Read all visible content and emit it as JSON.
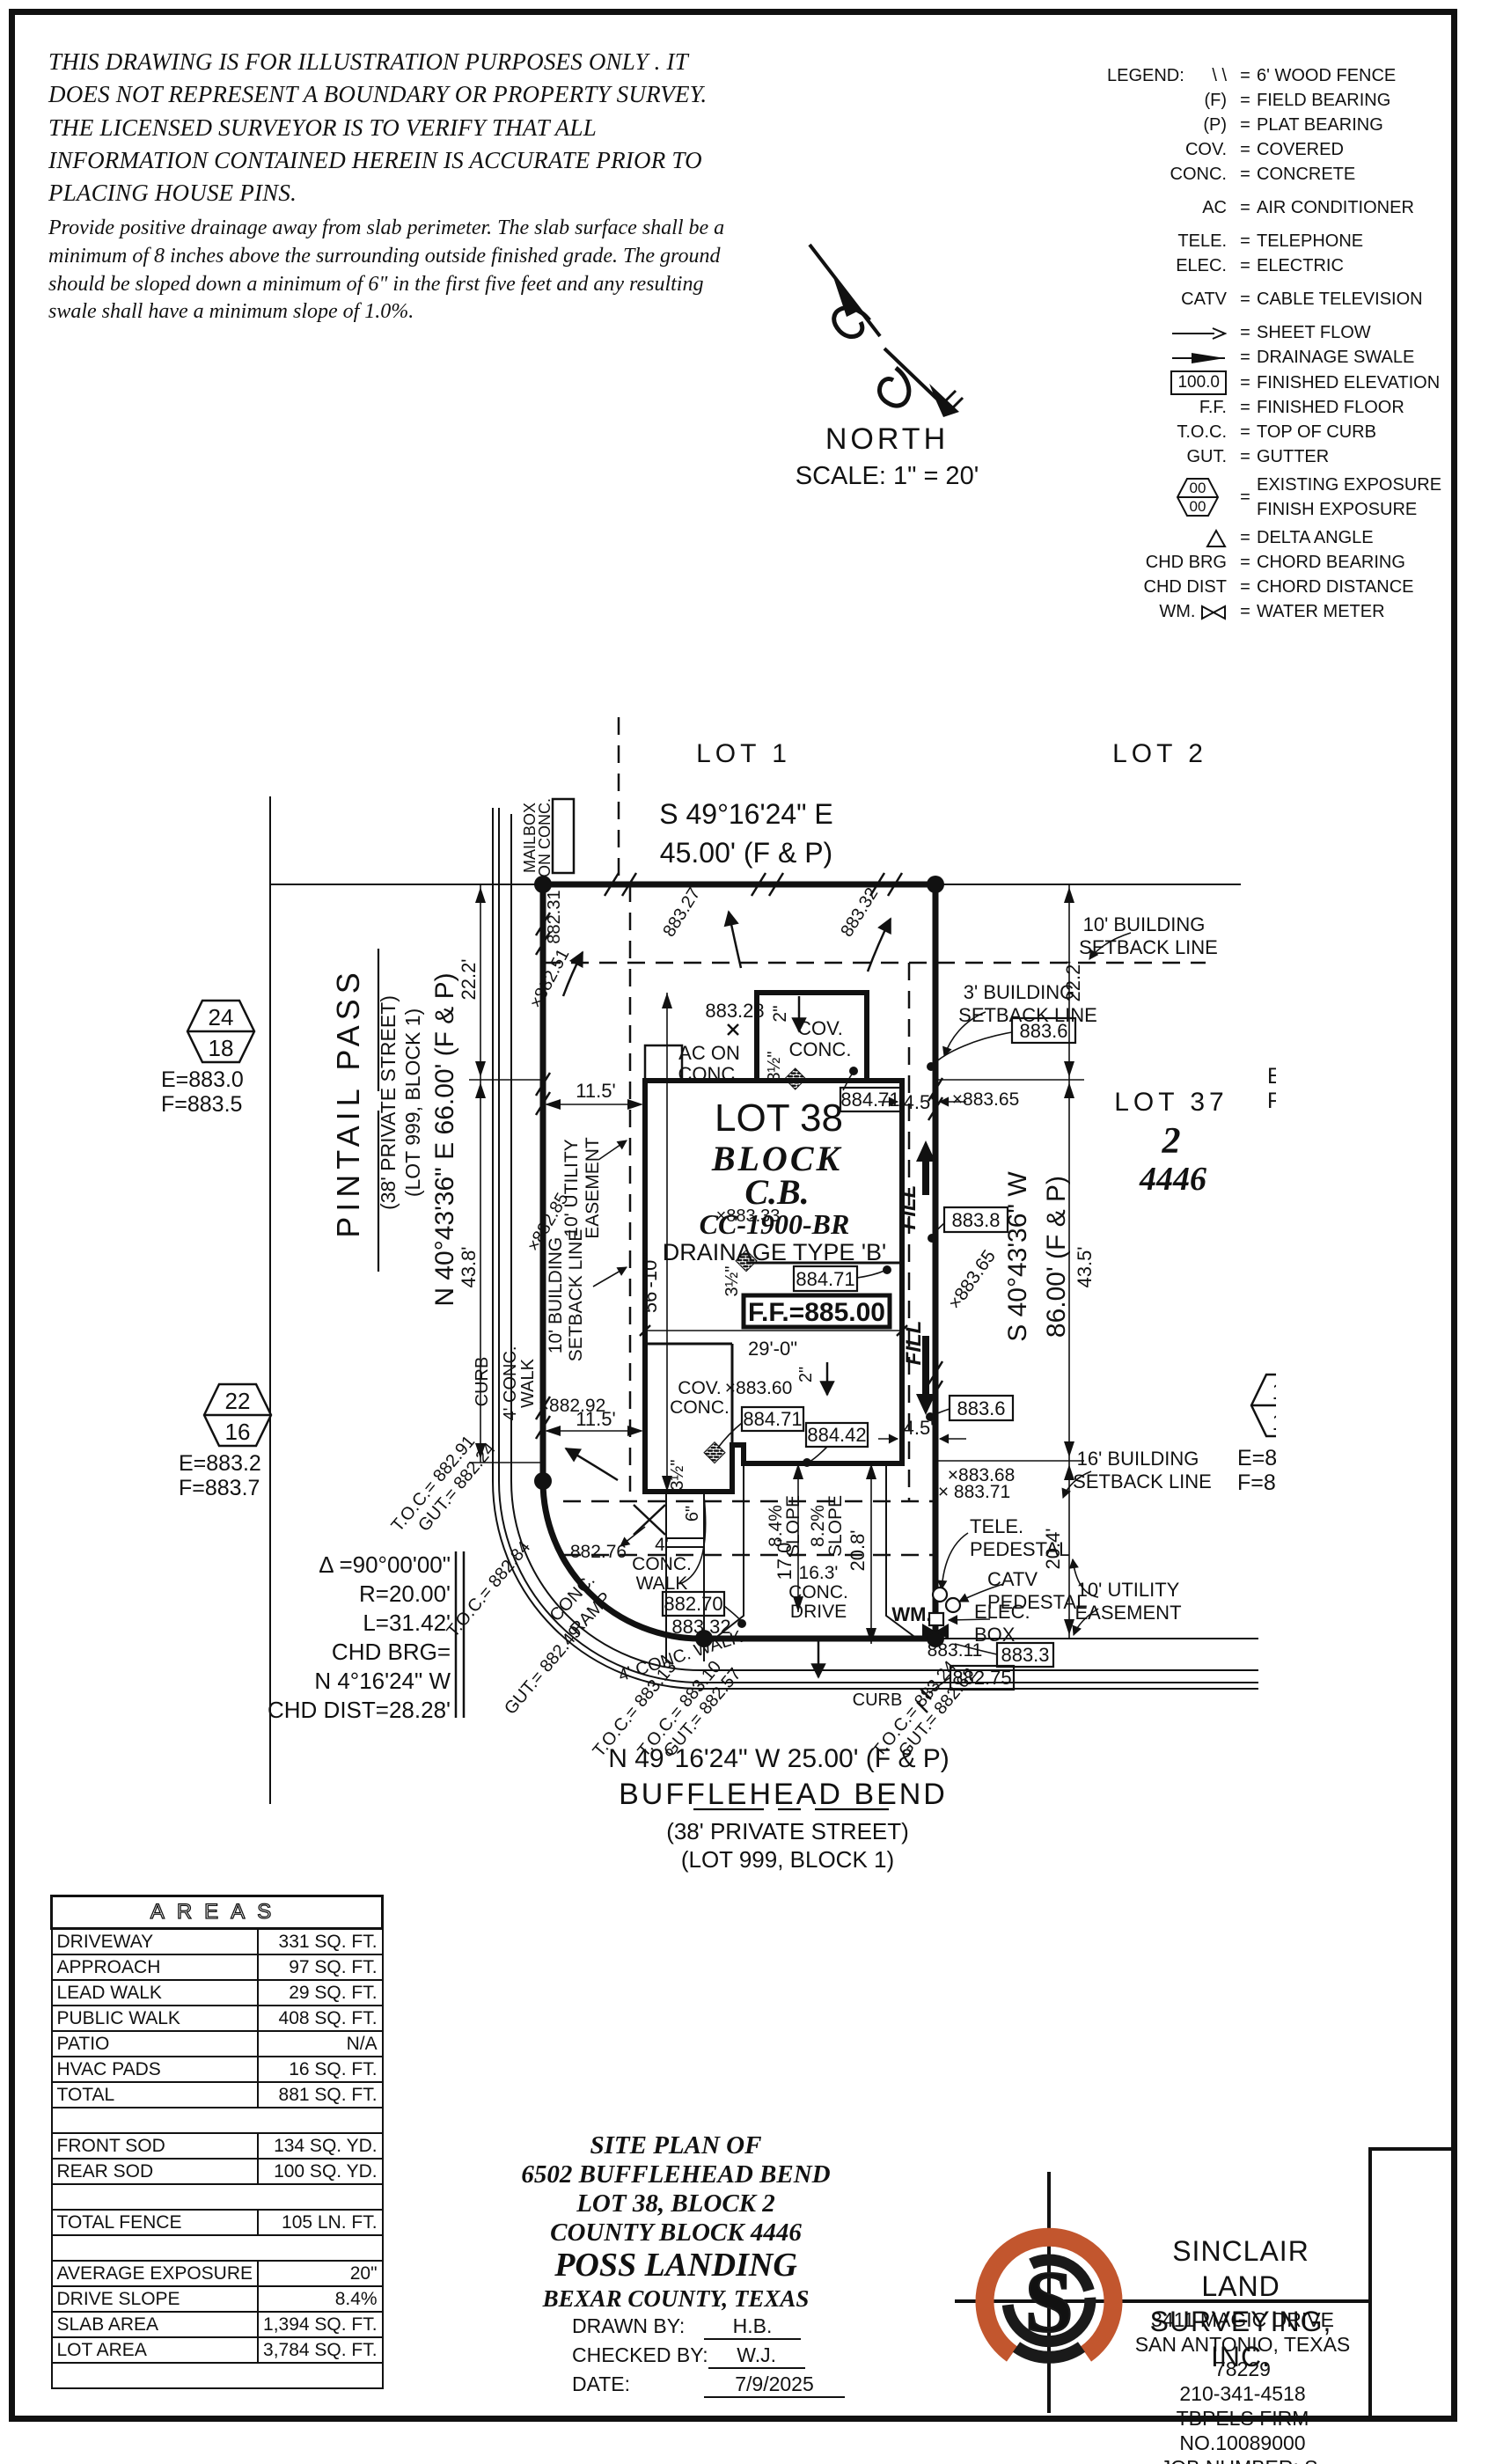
{
  "colors": {
    "logo_orange": "#c2562e",
    "ink": "#111111"
  },
  "disclaimer": {
    "p1": "THIS DRAWING IS FOR ILLUSTRATION PURPOSES ONLY . IT DOES NOT REPRESENT A BOUNDARY OR PROPERTY SURVEY. THE LICENSED SURVEYOR IS TO VERIFY THAT ALL INFORMATION CONTAINED HEREIN IS ACCURATE PRIOR TO PLACING HOUSE PINS.",
    "p2": "Provide positive drainage away from slab perimeter. The slab surface shall be a minimum of 8 inches above the surrounding outside finished grade. The ground should be sloped down a minimum of 6\" in the first five feet and any resulting swale shall have a minimum slope of 1.0%."
  },
  "north": {
    "label": "NORTH",
    "scale": "SCALE: 1\" = 20'"
  },
  "legend": {
    "title": "LEGEND:",
    "eq": "=",
    "hex_top": "00",
    "hex_bottom": "00",
    "rows": [
      {
        "s": "\\ \\",
        "d": "6' WOOD FENCE"
      },
      {
        "s": "(F)",
        "d": "FIELD BEARING"
      },
      {
        "s": "(P)",
        "d": "PLAT BEARING"
      },
      {
        "s": "COV.",
        "d": "COVERED"
      },
      {
        "s": "CONC.",
        "d": "CONCRETE"
      },
      {
        "s": "AC",
        "d": "AIR CONDITIONER"
      },
      {
        "s": "TELE.",
        "d": "TELEPHONE"
      },
      {
        "s": "ELEC.",
        "d": "ELECTRIC"
      },
      {
        "s": "CATV",
        "d": "CABLE TELEVISION"
      },
      {
        "s": "",
        "d": "SHEET FLOW"
      },
      {
        "s": "",
        "d": "DRAINAGE SWALE"
      },
      {
        "s": "100.0",
        "d": "FINISHED ELEVATION"
      },
      {
        "s": "F.F.",
        "d": "FINISHED FLOOR"
      },
      {
        "s": "T.O.C.",
        "d": "TOP OF CURB"
      },
      {
        "s": "GUT.",
        "d": "GUTTER"
      },
      {
        "s": "",
        "d1": "EXISTING EXPOSURE",
        "d2": "FINISH EXPOSURE"
      },
      {
        "s": "",
        "d": "DELTA ANGLE"
      },
      {
        "s": "CHD BRG",
        "d": "CHORD BEARING"
      },
      {
        "s": "CHD DIST",
        "d": "CHORD DISTANCE"
      },
      {
        "s": "WM.",
        "d": "WATER METER"
      }
    ]
  },
  "plan": {
    "lot1": "LOT 1",
    "lot2": "LOT 2",
    "brg_top1": "S 49°16'24\" E",
    "brg_top2": "45.00' (F & P)",
    "mailbox1": "MAILBOX",
    "mailbox2": "ON CONC.",
    "street_left": "PINTAIL PASS",
    "street_left_sub1": "(38' PRIVATE STREET)",
    "street_left_sub2": "(LOT 999, BLOCK 1)",
    "brg_left": "N 40°43'36\" E 66.00' (F & P)",
    "brg_right1": "S 40°43'36\" W",
    "brg_right2": "86.00' (F & P)",
    "brg_bottom": "N 49°16'24\" W 25.00' (F & P)",
    "street_bottom": "BUFFLEHEAD BEND",
    "street_bottom_sub1": "(38' PRIVATE STREET)",
    "street_bottom_sub2": "(LOT 999, BLOCK 1)",
    "lot38": "LOT 38",
    "block_label": "BLOCK",
    "block_cb": "C.B.",
    "plan_code": "CC-1900-BR",
    "drainage": "DRAINAGE TYPE 'B'",
    "ff": "F.F.=885.00",
    "lot37": "LOT 37",
    "lot37_blk": "2",
    "lot37_cb": "4446",
    "sb10r1": "10' BUILDING",
    "sb10r2": "SETBACK LINE",
    "sb3r1": "3' BUILDING",
    "sb3r2": "SETBACK LINE",
    "sb16r1": "16' BUILDING",
    "sb16r2": "SETBACK LINE",
    "ue10r1": "10' UTILITY",
    "ue10r2": "EASEMENT",
    "ue10l1": "10' UTILITY",
    "ue10l2": "EASEMENT",
    "sb10l1": "10' BUILDING",
    "sb10l2": "SETBACK LINE",
    "ac1": "AC ON",
    "ac2": "CONC.",
    "cov1a": "COV.",
    "cov1b": "CONC.",
    "cov2a": "COV.",
    "cov2b": "CONC.",
    "e88360": "×883.60",
    "e88231": "882.31",
    "e88251": "×882.51",
    "e88327": "883.27",
    "e88332": "883.32",
    "e88328": "883.28",
    "e88333": "×883.33",
    "e88365a": "×883.65",
    "e88365b": "×883.65",
    "e88285": "×882.85",
    "e88292": "×882.92",
    "e88368": "×883.68",
    "e88371": "× 883.71",
    "e88276": "882.76",
    "e88311": "883.11",
    "e88332b": "883.32",
    "b471a": "884.71",
    "b471b": "884.71",
    "b471c": "884.71",
    "b836a": "883.6",
    "b836b": "883.6",
    "b838": "883.8",
    "b442": "884.42",
    "b270": "882.70",
    "b833": "883.3",
    "b275": "882.75",
    "d222l": "22.2'",
    "d438": "43.8'",
    "d222r": "22.2'",
    "d435": "43.5'",
    "d204": "20.4'",
    "d115a": "11.5'",
    "d115b": "11.5'",
    "d45a": "4.5'",
    "d45b": "4.5'",
    "d5610": "56'-10\"",
    "d290": "29'-0\"",
    "d170": "17.0'",
    "d208": "20.8'",
    "d163a": "16.3'",
    "d163b": "CONC.",
    "d163c": "DRIVE",
    "slope1a": "8.4%",
    "slope1b": "SLOPE",
    "slope2a": "8.2%",
    "slope2b": "SLOPE",
    "d2a": "2\"",
    "d2b": "2\"",
    "d6": "6\"",
    "d35a": "3½\"",
    "d35b": "3½\"",
    "d35c": "3½\"",
    "fill1": "FILL",
    "fill2": "FILL",
    "wm": "WM.",
    "tele1": "TELE.",
    "tele2": "PEDESTAL",
    "catv1": "CATV",
    "catv2": "PEDESTAL",
    "elec1": "ELEC.",
    "elec2": "BOX",
    "curb_l": "CURB",
    "curb_b": "CURB",
    "walk_l1": "4' CONC.",
    "walk_l2": "WALK",
    "walk_b": "4' CONC. WALK",
    "walk_c1": "4'",
    "walk_c2": "CONC.",
    "walk_c3": "WALK",
    "ramp1": "CONC.",
    "ramp2": "RAMP",
    "toc_a": "T.O.C.= 882.91",
    "gut_a": "GUT.= 882.24",
    "toc_b": "T.O.C.= 882.84",
    "gut_c": "GUT.= 882.49",
    "toc_d": "T.O.C.= 883.13",
    "toc_e": "T.O.C.= 883.10",
    "gut_e": "GUT.= 882.57",
    "toc_f": "T.O.C.= 883.24",
    "gut_f": "GUT.= 882.62",
    "curve1": "Δ =90°00'00\"",
    "curve2": "R=20.00'",
    "curve3": "L=31.42'",
    "curve4": "CHD BRG=",
    "curve5": "N 4°16'24\" W",
    "curve6": "CHD DIST=28.28'",
    "h1t": "24",
    "h1b": "18",
    "h1e": "E=883.0",
    "h1f": "F=883.5",
    "h2t": "22",
    "h2b": "16",
    "h2e": "E=883.2",
    "h2f": "F=883.7",
    "h3t": "17",
    "h3b": "11",
    "h3e": "E=883.6",
    "h3f": "F=884.1",
    "h4t": "17",
    "h4b": "10",
    "h4e": "E=883.6",
    "h4f": "F=884.2"
  },
  "areas": {
    "title": "AREAS",
    "rows": [
      {
        "label": "DRIVEWAY",
        "value": "331 SQ. FT."
      },
      {
        "label": "APPROACH",
        "value": "97 SQ. FT."
      },
      {
        "label": "LEAD WALK",
        "value": "29 SQ. FT."
      },
      {
        "label": "PUBLIC WALK",
        "value": "408 SQ. FT."
      },
      {
        "label": "PATIO",
        "value": "N/A"
      },
      {
        "label": "HVAC PADS",
        "value": "16 SQ. FT."
      },
      {
        "label": "TOTAL",
        "value": "881 SQ. FT."
      },
      {
        "label": "",
        "value": ""
      },
      {
        "label": "FRONT SOD",
        "value": "134 SQ. YD."
      },
      {
        "label": "REAR SOD",
        "value": "100 SQ. YD."
      },
      {
        "label": "",
        "value": ""
      },
      {
        "label": "TOTAL FENCE",
        "value": "105 LN. FT."
      },
      {
        "label": "",
        "value": ""
      },
      {
        "label": "AVERAGE EXPOSURE",
        "value": "20\""
      },
      {
        "label": "DRIVE SLOPE",
        "value": "8.4%"
      },
      {
        "label": "SLAB AREA",
        "value": "1,394 SQ. FT."
      },
      {
        "label": "LOT AREA",
        "value": "3,784 SQ. FT."
      },
      {
        "label": "",
        "value": ""
      }
    ]
  },
  "titleblock": {
    "l1": "SITE PLAN OF",
    "l2": "6502 BUFFLEHEAD BEND",
    "l3": "LOT 38, BLOCK 2",
    "l4": "COUNTY BLOCK 4446",
    "l5": "POSS LANDING",
    "l6": "BEXAR COUNTY, TEXAS",
    "drawn_label": "DRAWN BY:",
    "drawn": "H.B.",
    "checked_label": "CHECKED BY:",
    "checked": "W.J.",
    "date_label": "DATE:",
    "date": "7/9/2025"
  },
  "firm": {
    "logo_letter": "S",
    "name1": "SINCLAIR LAND",
    "name2": "SURVEYING, INC.",
    "addr1": "3411 MAGIC DRIVE",
    "addr2": "SAN ANTONIO, TEXAS 78229",
    "phone": "210-341-4518",
    "firmno": "TBPELS FIRM NO.10089000",
    "job": "JOB NUMBER: S-202582538"
  }
}
